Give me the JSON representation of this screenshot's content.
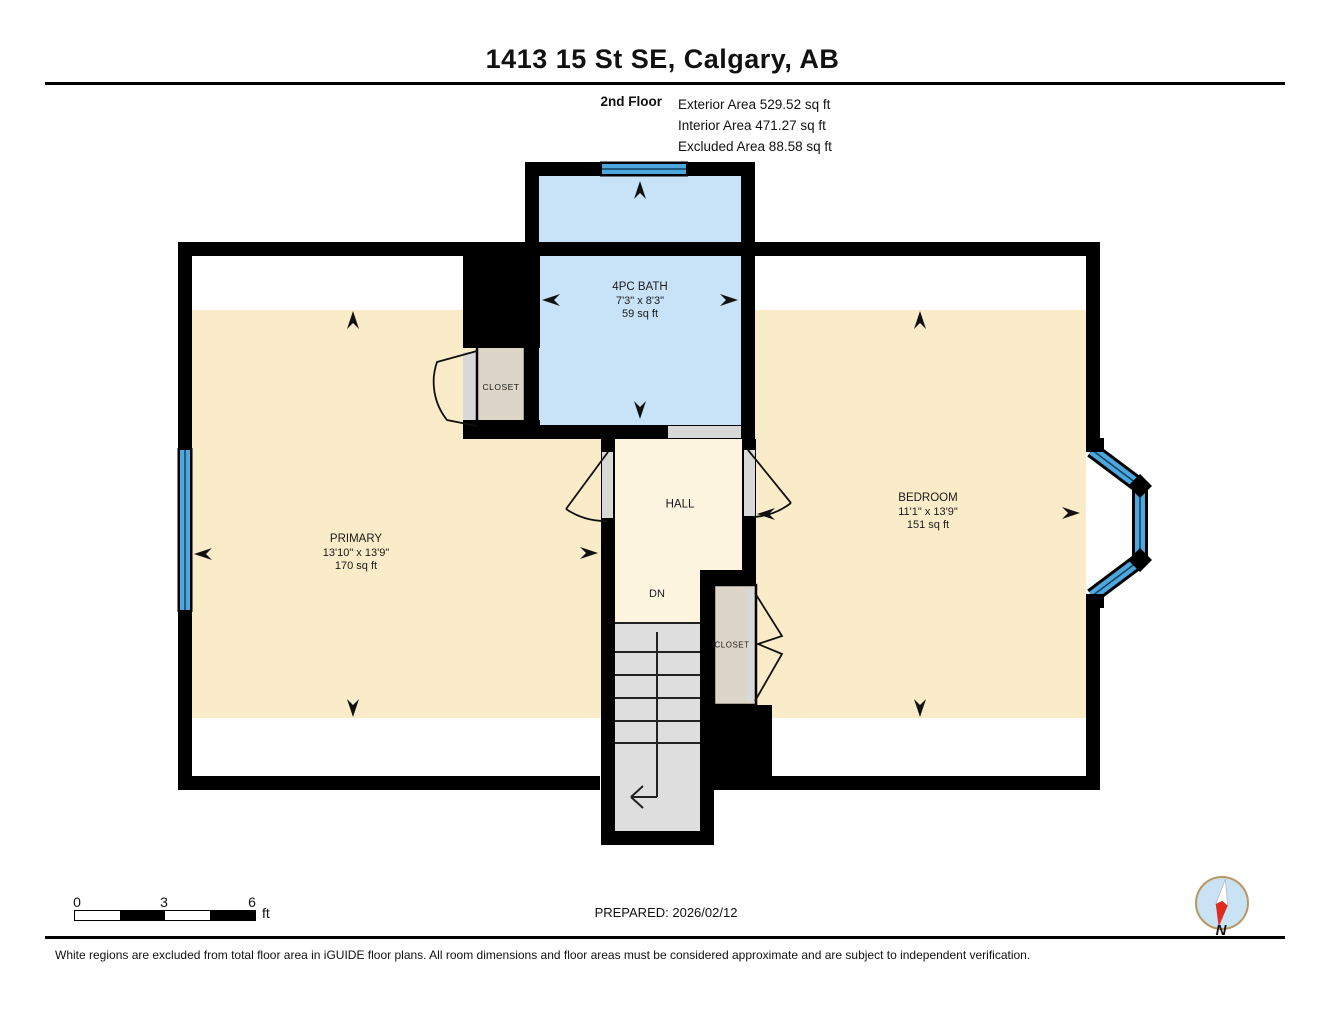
{
  "header": {
    "title": "1413 15 St SE, Calgary, AB",
    "floor_label": "2nd Floor",
    "area_lines": [
      "Exterior Area 529.52 sq ft",
      "Interior Area 471.27 sq ft",
      "Excluded Area 88.58 sq ft"
    ]
  },
  "rooms": {
    "bath": {
      "name": "4PC BATH",
      "dims": "7'3\" x 8'3\"",
      "area": "59 sq ft"
    },
    "primary": {
      "name": "PRIMARY",
      "dims": "13'10\" x 13'9\"",
      "area": "170 sq ft"
    },
    "bedroom": {
      "name": "BEDROOM",
      "dims": "11'1\" x 13'9\"",
      "area": "151 sq ft"
    },
    "hall": {
      "name": "HALL"
    },
    "stairs": {
      "direction_label": "DN"
    },
    "closet_bath": {
      "name": "CLOSET"
    },
    "closet_bedroom": {
      "name": "CLOSET"
    }
  },
  "scale_bar": {
    "ticks": [
      "0",
      "3",
      "6"
    ],
    "unit": "ft"
  },
  "footer": {
    "prepared_label": "PREPARED: 2026/02/12",
    "compass_label": "N",
    "disclaimer": "White regions are excluded from total floor area in iGUIDE floor plans. All room dimensions and floor areas must be considered approximate and are subject to independent verification."
  },
  "colors": {
    "wall": "#000000",
    "room_fill": "#faecc9",
    "hall_fill": "#fdf4e0",
    "bath_fill": "#c8e2f7",
    "window_blue": "#4da6dc",
    "closet_fill": "#ddd6c8",
    "stairs_fill": "#dedede",
    "excluded_fill": "#ffffff",
    "compass_ring": "#b9985f",
    "compass_face": "#c9e3f5",
    "compass_needle_red": "#e02b20"
  }
}
